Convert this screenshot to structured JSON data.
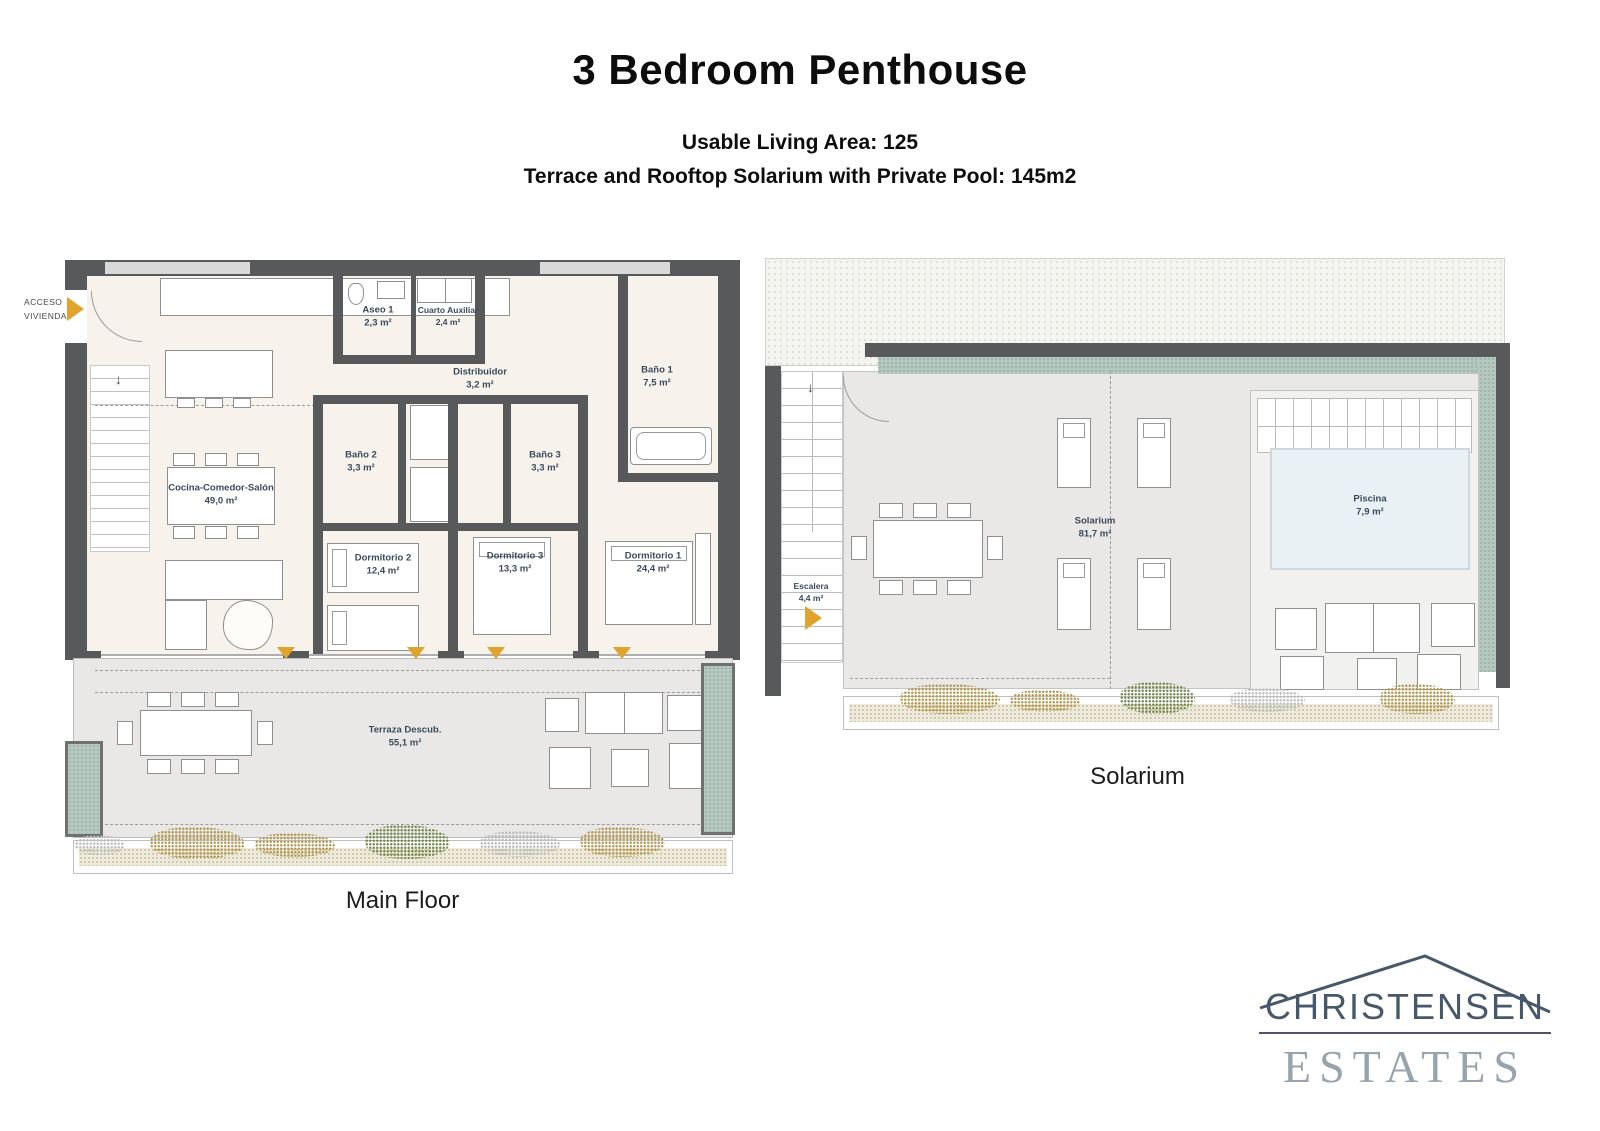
{
  "header": {
    "title": "3 Bedroom Penthouse",
    "subtitle1": "Usable Living Area: 125",
    "subtitle2": "Terrace and Rooftop Solarium with Private Pool: 145m2"
  },
  "main_floor": {
    "caption": "Main Floor",
    "access_line1": "ACCESO",
    "access_line2": "VIVIENDA",
    "rooms": {
      "cocina": {
        "name": "Cocina-Comedor-Salón",
        "area": "49,0 m²"
      },
      "aseo1": {
        "name": "Aseo 1",
        "area": "2,3 m²"
      },
      "cuarto_auxiliar": {
        "name": "Cuarto Auxiliar",
        "area": "2,4 m²"
      },
      "distribuidor": {
        "name": "Distribuidor",
        "area": "3,2 m²"
      },
      "bano1": {
        "name": "Baño 1",
        "area": "7,5 m²"
      },
      "bano2": {
        "name": "Baño 2",
        "area": "3,3 m²"
      },
      "bano3": {
        "name": "Baño 3",
        "area": "3,3 m²"
      },
      "dormitorio2": {
        "name": "Dormitorio 2",
        "area": "12,4 m²"
      },
      "dormitorio3": {
        "name": "Dormitorio 3",
        "area": "13,3 m²"
      },
      "dormitorio1": {
        "name": "Dormitorio 1",
        "area": "24,4 m²"
      },
      "terraza": {
        "name": "Terraza Descub.",
        "area": "55,1 m²"
      }
    }
  },
  "solarium_floor": {
    "caption": "Solarium",
    "rooms": {
      "escalera": {
        "name": "Escalera",
        "area": "4,4 m²"
      },
      "solarium": {
        "name": "Solarium",
        "area": "81,7 m²"
      },
      "piscina": {
        "name": "Piscina",
        "area": "7,9 m²"
      }
    }
  },
  "logo": {
    "line1": "CHRISTENSEN",
    "line2": "ESTATES"
  },
  "colors": {
    "wall": "#58595b",
    "accent_arrow": "#dfa42b",
    "planter_green": "#b5c8bf",
    "pool_blue": "#e9f1f5",
    "label_text": "#3a4a5c"
  }
}
